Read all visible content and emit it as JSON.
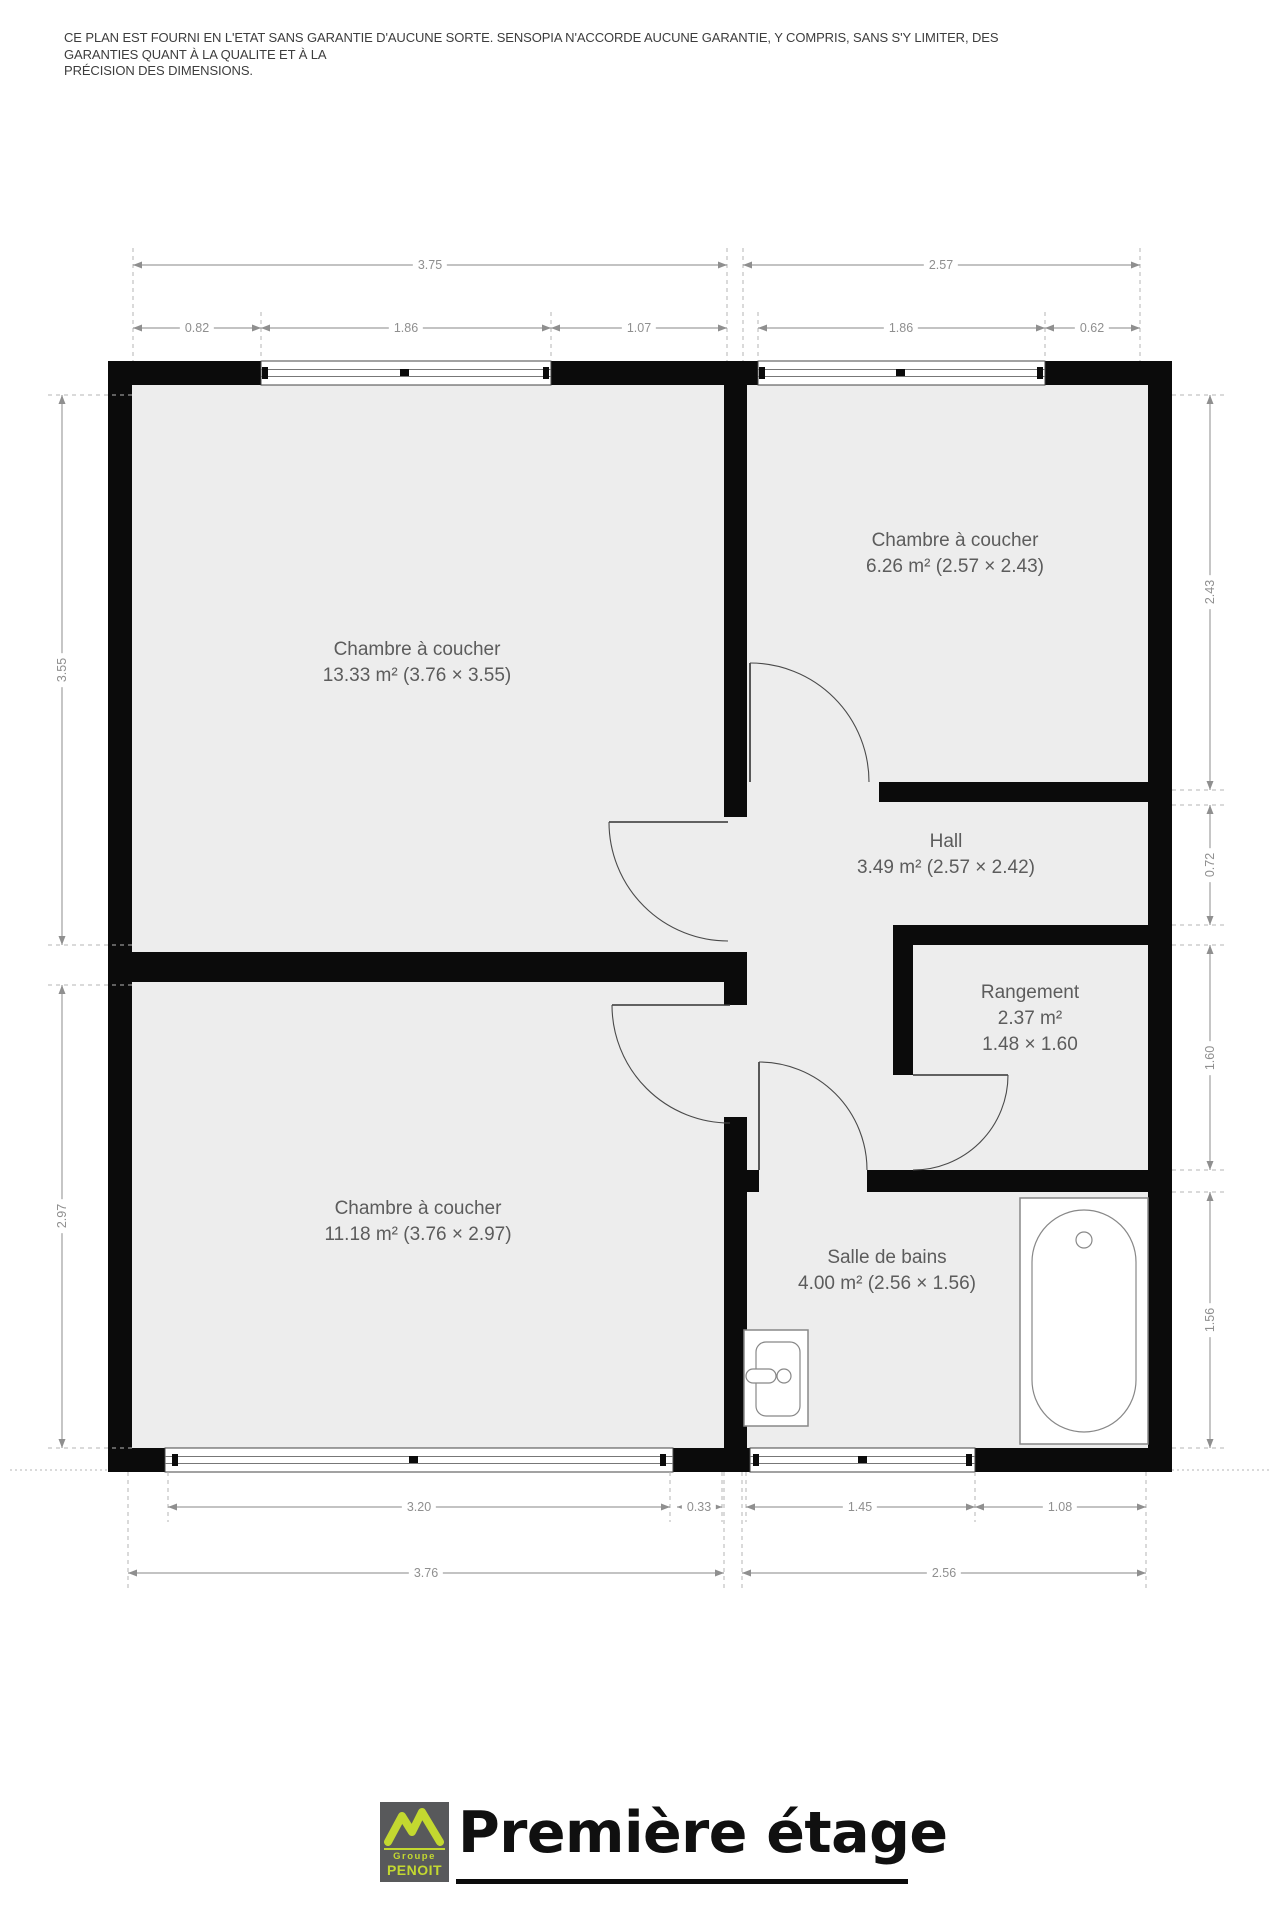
{
  "disclaimer": {
    "line1": "CE PLAN EST FOURNI EN L'ETAT SANS GARANTIE D'AUCUNE SORTE. SENSOPIA N'ACCORDE AUCUNE GARANTIE, Y COMPRIS, SANS S'Y LIMITER, DES GARANTIES QUANT À LA QUALITE ET À LA",
    "line2": "PRÉCISION DES DIMENSIONS."
  },
  "floor_title": "Première étage",
  "logo": {
    "group": "Groupe",
    "name": "PENOIT"
  },
  "rooms": {
    "bedroom_top_left": {
      "name": "Chambre à coucher",
      "area": "13.33 m² (3.76 × 3.55)"
    },
    "bedroom_top_right": {
      "name": "Chambre à coucher",
      "area": "6.26 m² (2.57 × 2.43)"
    },
    "hall": {
      "name": "Hall",
      "area": "3.49 m² (2.57 × 2.42)"
    },
    "storage": {
      "name": "Rangement",
      "area": "2.37 m²",
      "dims": "1.48 × 1.60"
    },
    "bedroom_bottom_left": {
      "name": "Chambre à coucher",
      "area": "11.18 m² (3.76 × 2.97)"
    },
    "bathroom": {
      "name": "Salle de bains",
      "area": "4.00 m² (2.56 × 1.56)"
    }
  },
  "dimensions": {
    "top": {
      "d375": "3.75",
      "d257": "2.57",
      "d082": "0.82",
      "d186_left": "1.86",
      "d107": "1.07",
      "d186_right": "1.86",
      "d062": "0.62"
    },
    "bottom": {
      "d320": "3.20",
      "d033": "0.33",
      "d145": "1.45",
      "d108": "1.08",
      "d376": "3.76",
      "d256": "2.56"
    },
    "left": {
      "d355": "3.55",
      "d297": "2.97"
    },
    "right": {
      "d243": "2.43",
      "d072": "0.72",
      "d160": "1.60",
      "d156": "1.56"
    }
  },
  "colors": {
    "wall": "#0b0b0b",
    "room_fill": "#ededed",
    "dimension": "#9a9a9a",
    "label_text": "#5c5c5c",
    "logo_bg": "#58595b",
    "logo_accent": "#c3d830",
    "title_text": "#101010"
  }
}
